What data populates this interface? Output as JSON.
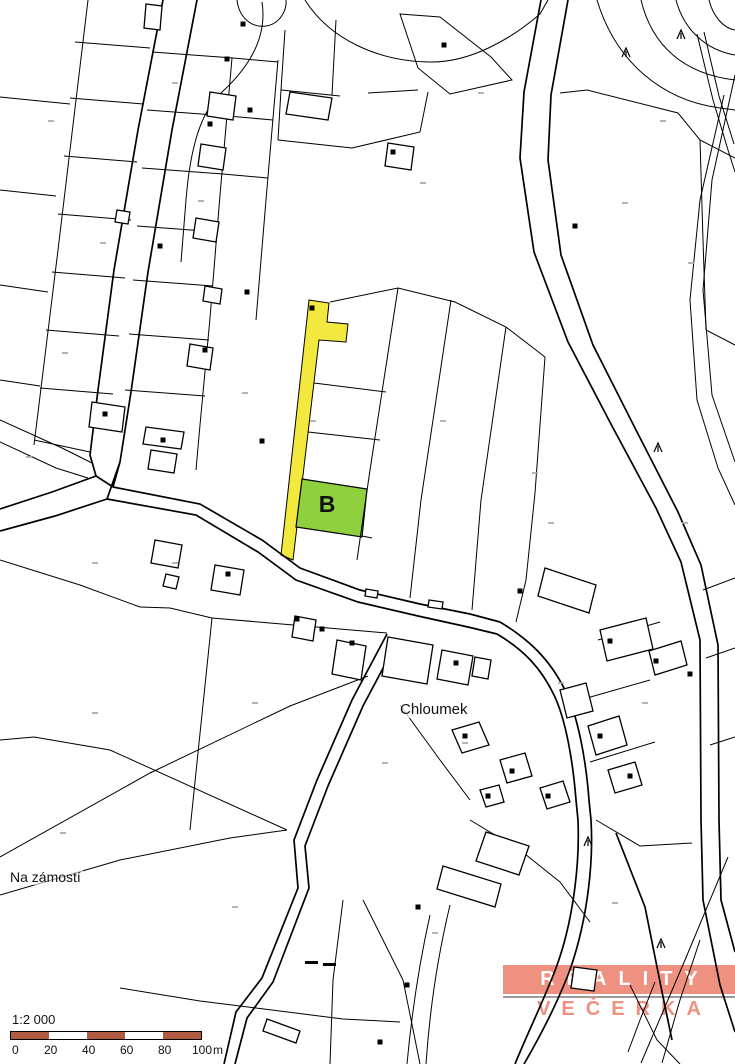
{
  "page": {
    "title": "Katastrální mapa 1:2 000"
  },
  "labels": {
    "chloumek": "Chloumek",
    "na_zamosti": "Na zámostí",
    "parcel_b": "B"
  },
  "logo": {
    "line1": "REALITY",
    "line2": "VEČERKA",
    "bg_color": "#ef9181",
    "line1_color": "#ffffff",
    "line2_color": "#ef9181",
    "divider_color": "#9a9a9a"
  },
  "scalebar": {
    "ratio_label": "1:2 000",
    "unit": "m",
    "unit_x": 205,
    "bar_color": "#b05c42",
    "bar_alt_color": "#ffffff",
    "segments": 5,
    "ticks": [
      {
        "label": "0",
        "x": 4
      },
      {
        "label": "20",
        "x": 36
      },
      {
        "label": "40",
        "x": 74
      },
      {
        "label": "60",
        "x": 112
      },
      {
        "label": "80",
        "x": 150
      },
      {
        "label": "100",
        "x": 184
      }
    ]
  },
  "map": {
    "background": "#ffffff",
    "line_color": "#000000",
    "highlights": {
      "yellow_parcel": {
        "fill": "#f3e93e",
        "path": "M309,300 L329,303 L327,322 L348,324 L346,342 L319,340 L293,560 L281,555 Z"
      },
      "green_parcel": {
        "fill": "#8ed03d",
        "path": "M302,479 L367,489 L362,537 L296,527 Z"
      }
    },
    "roads": [
      "M163,0 L138,130 L114,270 L98,390 L90,455 L96,476 L113,487",
      "M197,0 L172,130 L148,272 L131,392 L120,462 L113,487",
      "M120,462 L107,499",
      "M113,487 L200,504 L262,540 L300,568 L360,590 L420,604 L470,614 L500,622",
      "M107,499 L196,515 L258,552 L296,580 L358,602 L418,616 L468,627 L497,634",
      "M96,476 L52,492 L0,509",
      "M107,499 L55,516 L0,531",
      "M500,622 C530,640 550,660 565,690 C578,716 586,760 589,800 L591,820 C594,870 585,930 568,975 C555,1008 538,1040 524,1064",
      "M497,634 C524,650 541,668 554,695 C566,720 573,762 576,800 L578,820 C580,868 572,925 556,968 C544,1000 528,1032 515,1064",
      "M387,634 L352,700 L317,780 L294,840 L298,888 L262,978 L236,1012 L224,1064",
      "M398,640 L363,706 L328,786 L305,846 L309,888 L273,982 L247,1018 L235,1064",
      "M541,0 L524,92 L520,158 L534,252 L568,342 L612,426 L656,508 L681,562 L700,640 L701,820 L703,900 L720,985 L735,1032",
      "M568,0 L551,95 L548,160 L561,255 L593,345 L636,430 L678,512 L701,565 L718,645 L719,820 L721,900 L735,952",
      "M616,833 L645,907 L661,987 L672,1040"
    ],
    "parcel_lines": [
      "M88,0 L58,250 L42,380 L34,445",
      "M0,97 L70,104",
      "M0,190 L56,196",
      "M0,285 L48,292",
      "M0,380 L40,386",
      "M75,42 L150,48",
      "M70,98 L143,104",
      "M64,156 L137,162",
      "M58,214 L131,220",
      "M52,272 L125,278",
      "M46,330 L119,336",
      "M40,388 L113,394",
      "M34,440 L90,452",
      "M232,58 L220,195 L210,318 L200,425 L196,470",
      "M278,60 L266,200 L256,320",
      "M152,52 L233,58",
      "M147,110 L228,116",
      "M142,168 L223,174",
      "M137,226 L218,232",
      "M133,280 L213,286",
      "M129,334 L209,340",
      "M125,390 L205,396",
      "M233,58 L278,62",
      "M228,116 L273,120",
      "M223,174 L268,178",
      "M237,0 C239,18 252,28 266,26 C280,24 287,10 286,0",
      "M305,0 C330,40 380,62 432,62 C470,62 510,40 540,14 L548,0",
      "M262,2 C268,40 246,70 222,92 C200,112 190,150 186,200 L181,262",
      "M285,30 L281,90 L278,140",
      "M281,90 L340,96",
      "M336,20 L332,95",
      "M278,140 L352,148",
      "M352,148 L420,132 L428,92",
      "M400,14 L440,17 L491,57 L512,80 L450,94 L418,68 Z",
      "M368,93 L418,90",
      "M560,93 L587,90 L678,113 L700,140 L735,158",
      "M697,34 L713,100 L728,150 L735,172",
      "M704,32 L719,96 L734,144",
      "M700,140 L703,240 L706,330 L735,345",
      "M641,0 C652,46 684,74 735,80",
      "M676,0 C684,30 706,50 735,55",
      "M709,0 C713,16 723,28 735,30",
      "M597,0 C615,60 660,100 720,108 L735,110",
      "M724,95 L700,200 L690,300 L697,400 L718,468 L735,505",
      "M735,75 L712,180 L703,290 L712,395 L735,462",
      "M330,302 L398,288 L455,302 L506,327 L545,357",
      "M398,288 L370,470 L357,560",
      "M451,300 L421,500 L410,598",
      "M506,327 L481,500 L472,610",
      "M545,357 L535,493 L526,580 L516,622",
      "M314,383 L386,392",
      "M308,432 L380,440",
      "M362,536 L372,538",
      "M0,420 L62,448 L92,463",
      "M0,442 L56,468 L88,478",
      "M0,560 L80,585 L140,607",
      "M140,607 L170,608 L212,618",
      "M212,618 L387,633",
      "M212,618 L190,830",
      "M0,740 L34,737 L110,750 L287,830",
      "M0,857 L150,773 L290,706 L368,676",
      "M0,895 L120,860 L230,838 L287,830",
      "M120,988 L200,1001 L343,1019 L400,1022",
      "M343,900 L333,980 L330,1064",
      "M363,900 L403,980 L420,1064",
      "M430,915 C420,960 412,1010 407,1064",
      "M450,905 C438,955 430,1005 426,1064",
      "M728,857 L685,960 L641,1063",
      "M700,940 L680,1000 L662,1063",
      "M630,985 L657,1040 L680,1064",
      "M655,982 L640,1020 L628,1052",
      "M596,820 L640,846 L692,843",
      "M470,820 L520,850 L560,882 L590,922",
      "M703,590 L735,578",
      "M706,658 L735,648",
      "M710,745 L735,737",
      "M598,640 L660,622",
      "M580,700 L650,680",
      "M590,762 L655,742",
      "M400,705 L440,760 L470,800"
    ],
    "buildings": [
      "M146,4 L162,6 L160,30 L144,28 Z",
      "M210,92 L236,96 L233,120 L207,116 Z",
      "M201,144 L226,148 L223,170 L198,166 Z",
      "M196,218 L219,222 L216,242 L193,238 Z",
      "M117,210 L130,212 L128,224 L115,222 Z",
      "M205,286 L222,289 L220,304 L203,301 Z",
      "M190,344 L213,348 L210,370 L187,366 Z",
      "M92,402 L125,407 L122,432 L89,427 Z",
      "M146,427 L184,432 L181,449 L143,444 Z",
      "M151,450 L177,454 L174,473 L148,469 Z",
      "M290,92 L332,98 L328,120 L286,114 Z",
      "M388,143 L414,147 L411,170 L385,166 Z",
      "M155,540 L182,545 L178,568 L151,563 Z",
      "M166,574 L179,577 L176,589 L163,586 Z",
      "M215,565 L244,570 L240,595 L211,590 Z",
      "M337,640 L366,646 L361,680 L332,674 Z",
      "M388,637 L433,645 L427,684 L382,676 Z",
      "M442,650 L473,656 L468,685 L437,679 Z",
      "M475,657 L491,660 L488,679 L472,676 Z",
      "M295,616 L316,620 L313,641 L292,637 Z",
      "M545,568 L596,585 L589,613 L538,596 Z",
      "M600,630 L646,618 L653,649 L607,661 Z",
      "M649,651 L681,641 L687,665 L655,675 Z",
      "M560,690 L586,683 L593,711 L567,718 Z",
      "M588,726 L619,716 L627,745 L596,755 Z",
      "M608,770 L635,762 L642,785 L615,793 Z",
      "M452,730 L479,722 L489,745 L462,753 Z",
      "M500,760 L525,753 L532,776 L507,783 Z",
      "M540,788 L563,781 L570,802 L547,809 Z",
      "M480,790 L499,785 L504,802 L486,807 Z",
      "M486,832 L529,846 L519,875 L476,861 Z",
      "M443,866 L501,884 L495,907 L437,889 Z",
      "M574,967 L597,970 L594,991 L571,988 Z",
      "M267,1019 L300,1031 L296,1043 L263,1031 Z",
      "M366,589 L378,591 L377,598 L365,596 Z",
      "M429,600 L443,602 L442,609 L428,607 Z"
    ],
    "symbols": [
      [
        243,
        24
      ],
      [
        227,
        59
      ],
      [
        250,
        110
      ],
      [
        210,
        124
      ],
      [
        160,
        246
      ],
      [
        247,
        292
      ],
      [
        205,
        350
      ],
      [
        105,
        414
      ],
      [
        163,
        440
      ],
      [
        262,
        441
      ],
      [
        228,
        574
      ],
      [
        297,
        619
      ],
      [
        322,
        629
      ],
      [
        352,
        643
      ],
      [
        456,
        663
      ],
      [
        520,
        591
      ],
      [
        610,
        641
      ],
      [
        656,
        661
      ],
      [
        690,
        674
      ],
      [
        600,
        736
      ],
      [
        630,
        776
      ],
      [
        512,
        771
      ],
      [
        548,
        796
      ],
      [
        488,
        796
      ],
      [
        465,
        736
      ],
      [
        418,
        907
      ],
      [
        380,
        1042
      ],
      [
        407,
        985
      ],
      [
        575,
        226
      ],
      [
        393,
        152
      ],
      [
        444,
        45
      ],
      [
        312,
        308
      ]
    ],
    "trees": [
      [
        626,
        52
      ],
      [
        681,
        34
      ],
      [
        658,
        447
      ],
      [
        661,
        943
      ],
      [
        588,
        841
      ]
    ],
    "micro_marks": [
      [
        48,
        120
      ],
      [
        100,
        242
      ],
      [
        62,
        352
      ],
      [
        26,
        456
      ],
      [
        172,
        82
      ],
      [
        198,
        200
      ],
      [
        242,
        392
      ],
      [
        310,
        420
      ],
      [
        440,
        420
      ],
      [
        532,
        472
      ],
      [
        622,
        202
      ],
      [
        688,
        262
      ],
      [
        420,
        182
      ],
      [
        478,
        92
      ],
      [
        558,
        682
      ],
      [
        642,
        702
      ],
      [
        462,
        742
      ],
      [
        382,
        762
      ],
      [
        252,
        702
      ],
      [
        92,
        712
      ],
      [
        60,
        832
      ],
      [
        232,
        906
      ],
      [
        432,
        932
      ],
      [
        612,
        902
      ],
      [
        682,
        522
      ],
      [
        172,
        562
      ],
      [
        92,
        562
      ],
      [
        548,
        522
      ],
      [
        660,
        120
      ]
    ],
    "dashes": [
      [
        305,
        961,
        13,
        3
      ],
      [
        323,
        963,
        13,
        3
      ]
    ]
  }
}
